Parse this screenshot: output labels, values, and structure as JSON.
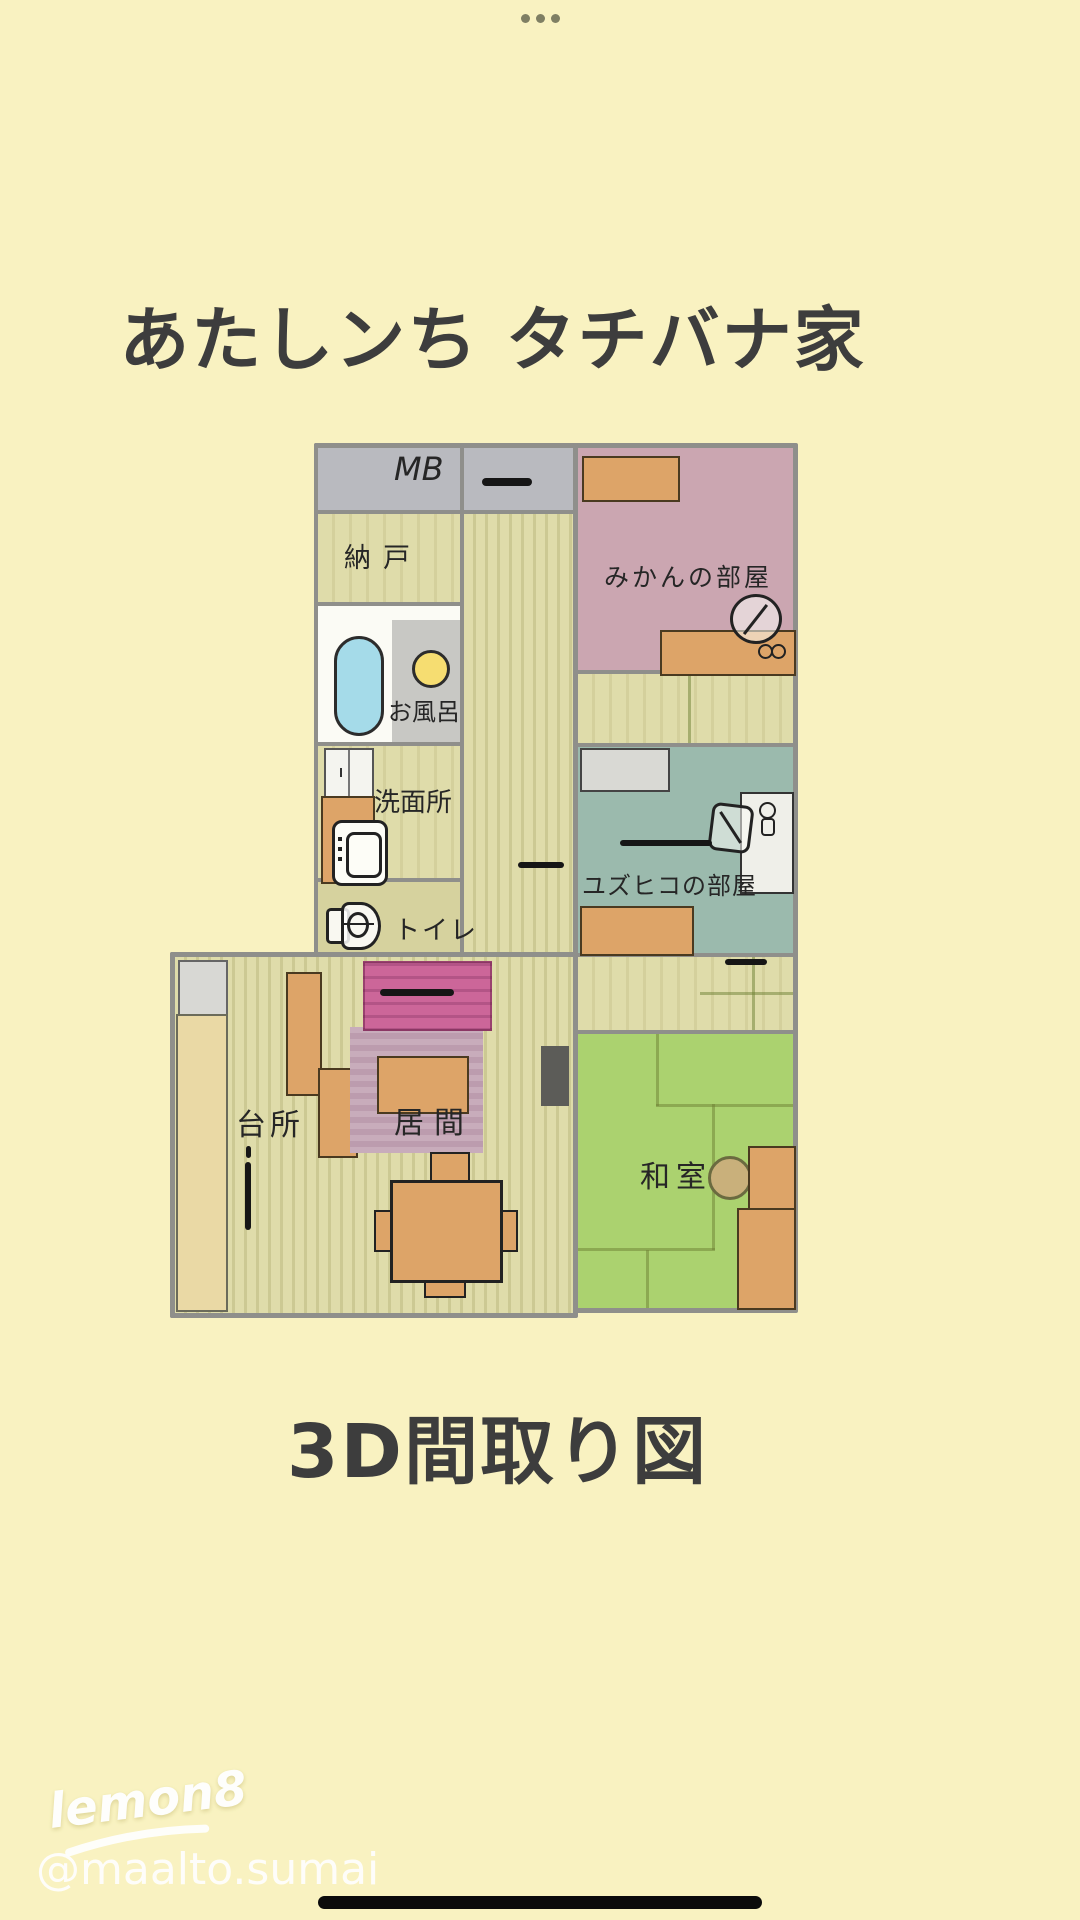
{
  "status": {
    "menu_dots": "• • •"
  },
  "header": {
    "title": "あたしンち タチバナ家"
  },
  "footer": {
    "caption": "3D間取り図"
  },
  "watermark": {
    "logo": "lemon8",
    "username": "@maalto.sumai"
  },
  "plan": {
    "rooms": {
      "mb": {
        "label": "MB"
      },
      "nando": {
        "label": "納戸"
      },
      "bath": {
        "label": "お風呂"
      },
      "washroom": {
        "label": "洗面所"
      },
      "toilet": {
        "label": "トイレ"
      },
      "mikan": {
        "label": "みかんの部屋"
      },
      "yuzuhiko": {
        "label": "ユズヒコの部屋"
      },
      "washitsu": {
        "label": "和室"
      },
      "kitchen": {
        "label": "台所"
      },
      "living": {
        "label": "居間"
      }
    }
  },
  "colors": {
    "page_bg": "#f9f2c1",
    "wall_gray": "#8f8f8b",
    "floor_tatami": "#dfdcaa",
    "toilet_floor": "#d6d29e",
    "mb_gray": "#b9babf",
    "mikan_pink": "#cba6b1",
    "yuzu_teal": "#9bbaad",
    "washitsu_green": "#abd26f",
    "furniture_orange": "#dda468",
    "counter_beige": "#ead9a5",
    "fridge_gray": "#d8d8d4",
    "shelf_gray": "#d9d9d4",
    "desk_white": "#efefe9",
    "bath_white": "#fbfbf5",
    "basin_gray": "#c8c8c4",
    "tv_stand_pink": "#cc6699",
    "rug_mauve": "#c2a3b3",
    "bathtub_blue": "#a5dbe9",
    "basin_yellow": "#f6dd71",
    "tv_dark": "#5c5c58",
    "table_tan": "#c9b07b",
    "text_dark": "#3d3d3d",
    "ink": "#262626"
  }
}
